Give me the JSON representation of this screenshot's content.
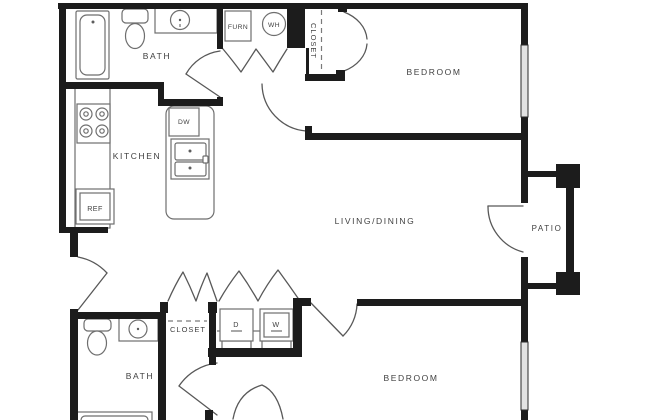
{
  "colors": {
    "background": "#ffffff",
    "walls": "#1c1c1c",
    "window_fill": "#e3e3e3",
    "fixture_outline": "#6e6e6e",
    "door_arc": "#585858",
    "label_text": "#3f3f3f"
  },
  "rooms": {
    "bath_top": "BATH",
    "kitchen": "KITCHEN",
    "living_dining": "LIVING/DINING",
    "bedroom_top": "BEDROOM",
    "patio": "PATIO",
    "closet_top": "CLOSET",
    "closet_bottom": "CLOSET",
    "bath_bottom": "BATH",
    "bedroom_bottom": "BEDROOM"
  },
  "equipment": {
    "furnace": "FURN",
    "water_heater": "WH",
    "dishwasher": "DW",
    "refrigerator": "REF",
    "dryer": "D",
    "washer": "W"
  }
}
